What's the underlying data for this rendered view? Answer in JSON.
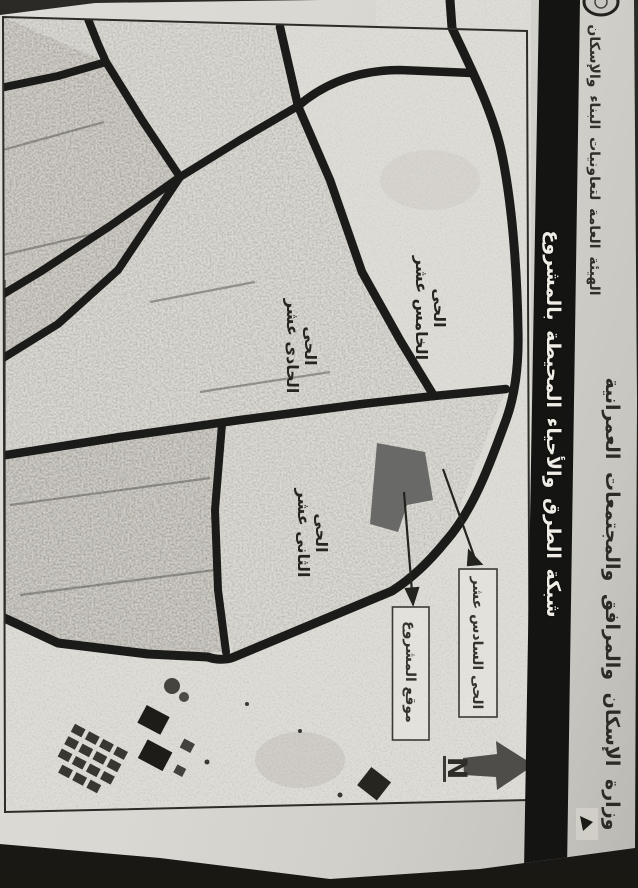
{
  "document": {
    "header": {
      "ministry_line": "وزارة الإسكان والمرافق والمجتمعات العمرانية",
      "authority_line": "الهيئة العامة لتعاونيات البناء والإسكان"
    },
    "title_band": {
      "title": "شبكة الطرق والأحياء المحيطة بالمشروع",
      "background": "#141412",
      "text_color": "#efede6"
    },
    "map": {
      "road_color": "#1b1b19",
      "project_site_color": "#696967",
      "north_arrow_color": "#4e4d4a",
      "districts": [
        {
          "id": "district-15",
          "line1": "الحى",
          "line2": "الخامس عشر"
        },
        {
          "id": "district-11",
          "line1": "الحى",
          "line2": "الحادى عشر"
        },
        {
          "id": "district-12",
          "line1": "الحى",
          "line2": "الثانى عشر"
        }
      ],
      "callouts": [
        {
          "id": "district-16",
          "label": "الحى السادس عشر"
        },
        {
          "id": "project-site",
          "label": "موقع المشروع"
        }
      ],
      "north_label": "N"
    }
  }
}
